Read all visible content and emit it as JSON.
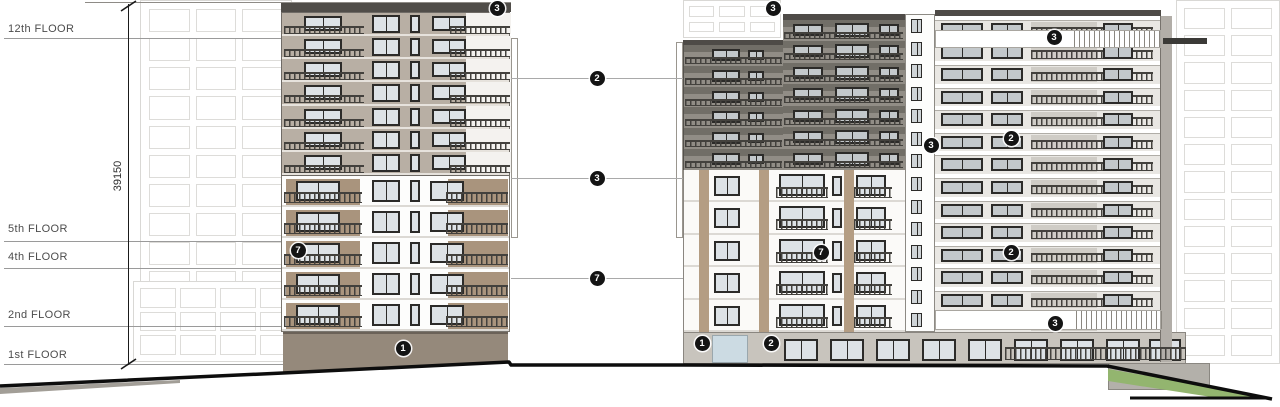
{
  "annotations": {
    "floor_labels": [
      {
        "label": "12th FLOOR",
        "text_y": 23,
        "line_y": 38
      },
      {
        "label": "5th FLOOR",
        "text_y": 223,
        "line_y": 241
      },
      {
        "label": "4th FLOOR",
        "text_y": 251,
        "line_y": 268
      },
      {
        "label": "2nd FLOOR",
        "text_y": 309,
        "line_y": 326
      },
      {
        "label": "1st FLOOR",
        "text_y": 349,
        "line_y": 364
      }
    ],
    "dimension_label": "39150",
    "markers": [
      {
        "label": "3",
        "x": 497,
        "y": 8
      },
      {
        "label": "2",
        "x": 597,
        "y": 78
      },
      {
        "label": "3",
        "x": 597,
        "y": 178
      },
      {
        "label": "7",
        "x": 597,
        "y": 278
      },
      {
        "label": "7",
        "x": 298,
        "y": 250
      },
      {
        "label": "1",
        "x": 403,
        "y": 348
      },
      {
        "label": "3",
        "x": 773,
        "y": 8
      },
      {
        "label": "3",
        "x": 931,
        "y": 145
      },
      {
        "label": "3",
        "x": 1054,
        "y": 37
      },
      {
        "label": "2",
        "x": 1011,
        "y": 138
      },
      {
        "label": "7",
        "x": 821,
        "y": 252
      },
      {
        "label": "2",
        "x": 1011,
        "y": 252
      },
      {
        "label": "3",
        "x": 1055,
        "y": 323
      },
      {
        "label": "1",
        "x": 702,
        "y": 343
      },
      {
        "label": "2",
        "x": 771,
        "y": 343
      }
    ],
    "colors": {
      "facade_taupe": "#b8afa4",
      "facade_dark_gray": "#918d86",
      "base_brown": "#95897b",
      "roof_dark": "#4e4b47",
      "accent_tan": "#a9947d",
      "grass_green": "#93b56f",
      "ground_line": "#0d0d0d",
      "marker_bg": "#141414"
    }
  }
}
